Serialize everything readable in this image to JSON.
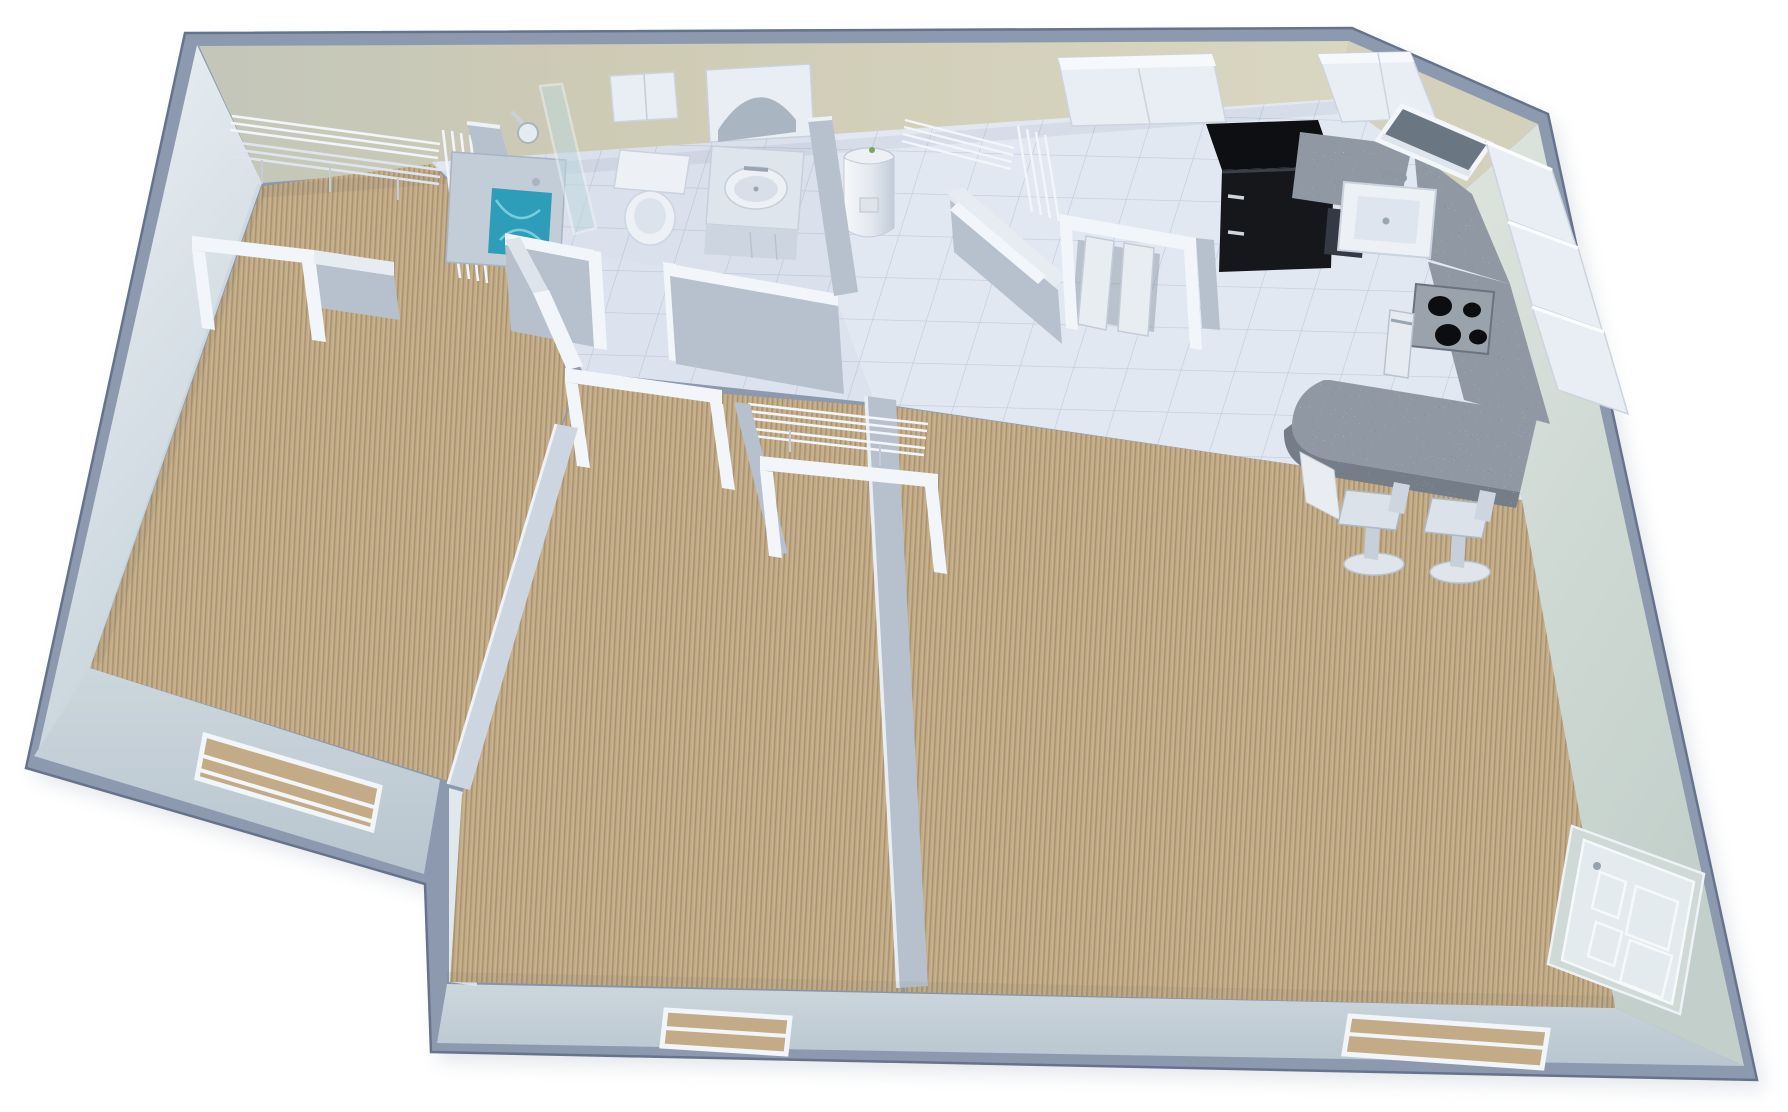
{
  "scene": {
    "description": "3D isometric dollhouse-view floor plan rendering of a one-story apartment with two carpeted bedrooms, a carpeted living room, tiled hallway, bathroom, utility and laundry closets, and a kitchen with granite counters and breakfast bar",
    "view": "overhead isometric render",
    "background": "#ffffff"
  },
  "palette": {
    "wall_top": "#8c99af",
    "wall_outline": "#66738d",
    "wall_face_far": "#c6c5b0",
    "wall_face_far_light": "#d9d6c2",
    "wall_face_left_top": "#eef3f6",
    "wall_face_left_bottom": "#c6d2da",
    "wall_face_right": "#cfd9d4",
    "wall_face_bottom": "#c4cfd7",
    "interior_wall_cap": "#f2f5f9",
    "interior_wall_face": "#b6c1cd",
    "tile_floor": "#e2e8f2",
    "carpet": "#c2ab86",
    "granite": "#9099a3",
    "granite_edge": "#757d88",
    "appliance_black": "#15171b",
    "fixture_white": "#edf1f6",
    "fixture_shadow": "#c7d0dc",
    "cabinet_white": "#e9eef4",
    "water": "#2d9db9",
    "glass": "#bdd9de",
    "metal": "#9aa2ab",
    "door_panel": "#e4ebee"
  },
  "rooms": [
    {
      "id": "bedroom-left",
      "label": "Bedroom (left)",
      "floor": "carpet",
      "features": [
        "walk-in closet with L-shaped wire shelving",
        "closet doorway",
        "entry door from hallway",
        "exterior window"
      ]
    },
    {
      "id": "bathroom",
      "label": "Bathroom",
      "floor": "tile",
      "fixtures": [
        "bathtub with water",
        "shower head",
        "glass shower door",
        "toilet",
        "over-toilet cabinet",
        "vanity with oval sink",
        "arched medicine cabinet mirror"
      ]
    },
    {
      "id": "utility-closet",
      "label": "Utility closet",
      "floor": "tile",
      "fixtures": [
        "water heater",
        "wire shelving",
        "angled doorway"
      ]
    },
    {
      "id": "laundry-closet",
      "label": "Laundry closet",
      "floor": "tile",
      "fixtures": [
        "bi-fold doors",
        "overhead cabinets"
      ]
    },
    {
      "id": "kitchen",
      "label": "Kitchen",
      "floor": "tile",
      "fixtures": [
        "black refrigerator",
        "upper cabinets",
        "granite countertops",
        "sink with faucet",
        "corner window",
        "four-burner range",
        "oven door",
        "dishwasher",
        "tall cabinets",
        "granite breakfast bar"
      ]
    },
    {
      "id": "hallway",
      "label": "Hallway",
      "floor": "tile",
      "features": [
        "bathroom doorway",
        "bedroom doorways",
        "closet openings"
      ]
    },
    {
      "id": "bedroom-middle",
      "label": "Bedroom (middle)",
      "floor": "carpet",
      "features": [
        "closet with wire shelf and rod",
        "closet opening",
        "entry door from hallway",
        "exterior window"
      ]
    },
    {
      "id": "living-room",
      "label": "Living room",
      "floor": "carpet",
      "features": [
        "entry door on right wall",
        "exterior window",
        "breakfast bar with two stools"
      ]
    }
  ],
  "counts": {
    "bedrooms": 2,
    "bathrooms": 1,
    "bar_stools": 2,
    "windows": 3,
    "exterior_doors": 1,
    "closets": 4
  }
}
